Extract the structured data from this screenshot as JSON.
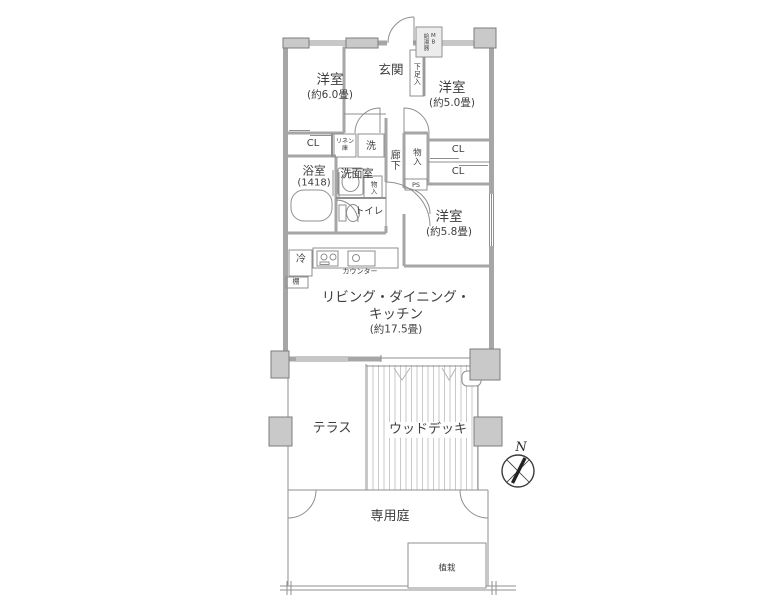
{
  "colors": {
    "wall_gray": "#a6a6a6",
    "line_gray": "#8f8f8f",
    "pillar_gray": "#c9c9c9",
    "text_gray": "#3f3f3f"
  },
  "rooms": {
    "bedroom1": {
      "name": "洋室",
      "size": "(約6.0畳)"
    },
    "bedroom2": {
      "name": "洋室",
      "size": "(約5.0畳)"
    },
    "bedroom3": {
      "name": "洋室",
      "size": "(約5.8畳)"
    },
    "ldk": {
      "name1": "リビング・ダイニング・",
      "name2": "キッチン",
      "size": "(約17.5畳)"
    },
    "entrance": {
      "name": "玄関"
    },
    "shoe_cabinet": {
      "name": "下足入"
    },
    "meter_box": {
      "name": "MB",
      "sub": "給湯器"
    },
    "bathroom": {
      "name": "浴室",
      "size": "(1418)"
    },
    "washroom": {
      "name": "洗面室"
    },
    "laundry": {
      "name": "洗"
    },
    "linen": {
      "name": "リネン庫"
    },
    "hallway": {
      "name": "廊下"
    },
    "toilet": {
      "name": "トイレ"
    },
    "storage_hall": {
      "name": "物入"
    },
    "storage_wash": {
      "name": "物入"
    },
    "pipe_space": {
      "name": "PS"
    },
    "closet_bed1": {
      "name": "CL"
    },
    "closet_bed2_upper": {
      "name": "CL"
    },
    "closet_bed2_lower": {
      "name": "CL"
    },
    "refrigerator": {
      "name": "冷"
    },
    "shelf": {
      "name": "棚"
    },
    "counter": {
      "name": "カウンター"
    },
    "terrace": {
      "name": "テラス"
    },
    "wood_deck": {
      "name": "ウッドデッキ"
    },
    "private_garden": {
      "name": "専用庭"
    },
    "planting": {
      "name": "植栽"
    }
  },
  "compass": {
    "north": "N"
  }
}
